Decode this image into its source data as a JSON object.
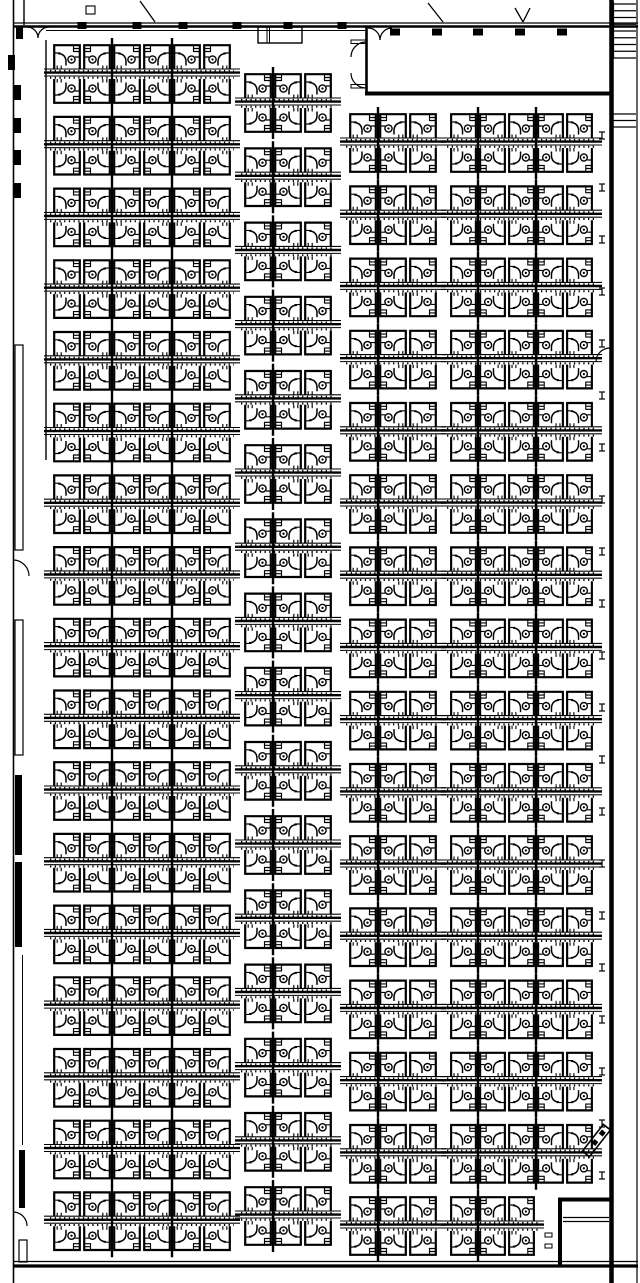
{
  "meta": {
    "canvas": {
      "w": 640,
      "h": 1283
    },
    "bg": "#ffffff",
    "ink": "#000000"
  },
  "plan": {
    "cluster": {
      "desk_h": 26,
      "spine_h": 10,
      "cluster_h": 62,
      "overhang": 8,
      "sep_rise": 5,
      "sep_drop": 67
    },
    "columns": [
      {
        "id": "left",
        "x": 52,
        "desk_w": 30,
        "desks": 6,
        "rows": 17,
        "row_start": 43,
        "row_step": 71.7,
        "separators": [
          2,
          4
        ]
      },
      {
        "id": "center",
        "x": 243,
        "desk_w": 30,
        "desks": 3,
        "rows": 16,
        "row_start": 72,
        "row_step": 74.2,
        "separators": [
          1
        ]
      },
      {
        "id": "right-inner",
        "x": 348,
        "desk_w": 30,
        "desks": 3,
        "rows": 16,
        "row_start": 112,
        "row_step": 72.2,
        "separators": [
          1
        ]
      },
      {
        "id": "right-outer",
        "x": 449,
        "desk_w": 29,
        "desks": 5,
        "rows": 16,
        "row_start": 112,
        "row_step": 72.2,
        "separators": [
          1,
          3
        ],
        "last_row_desks": 3
      }
    ],
    "walls": {
      "lines": [
        [
          13,
          23,
          638,
          23,
          1.2
        ],
        [
          13,
          26.5,
          638,
          26.5,
          2.4
        ],
        [
          46,
          30.5,
          365,
          30.5,
          1
        ],
        [
          13.5,
          0,
          13.5,
          1283,
          1.6
        ],
        [
          46,
          40,
          46,
          460,
          1.4
        ],
        [
          611.5,
          0,
          611.5,
          1283,
          4.5
        ],
        [
          637,
          0,
          637,
          1283,
          1.2
        ],
        [
          13,
          1261.5,
          638,
          1261.5,
          1.2
        ],
        [
          13,
          1266,
          638,
          1266,
          3.2
        ],
        [
          24,
          0,
          24,
          25,
          1.4
        ],
        [
          365,
          93.5,
          611,
          93.5,
          4
        ],
        [
          366.5,
          27,
          366.5,
          93,
          2.6
        ],
        [
          558,
          1199.5,
          611.5,
          1199.5,
          4
        ],
        [
          560,
          1199,
          560,
          1267,
          4
        ],
        [
          563,
          1217.5,
          609,
          1217.5,
          1.2
        ],
        [
          563,
          1221.5,
          609,
          1221.5,
          1.2
        ],
        [
          22.5,
          955,
          22.5,
          1145,
          1
        ]
      ],
      "filled": [
        [
          16,
          27,
          7,
          12
        ],
        [
          8,
          55,
          7,
          15
        ],
        [
          14,
          85,
          7,
          15
        ],
        [
          14,
          118,
          7,
          15
        ],
        [
          14,
          150,
          7,
          15
        ],
        [
          14,
          183,
          7,
          15
        ],
        [
          15,
          775,
          7,
          80
        ],
        [
          15,
          862,
          7,
          85
        ],
        [
          19,
          1150,
          6,
          58
        ]
      ],
      "outlined": [
        [
          15,
          345,
          8,
          205,
          1.2
        ],
        [
          15,
          620,
          8,
          135,
          1.2
        ],
        [
          19,
          1240,
          8,
          22,
          1.2
        ],
        [
          545,
          1233,
          7,
          4,
          1
        ],
        [
          545,
          1244,
          7,
          4,
          1
        ],
        [
          86,
          6,
          9,
          8,
          1.1
        ]
      ]
    },
    "doors": {
      "arcs": [
        "M27,27 A11,11 0 0 1 38,38",
        "M49,27 A11,11 0 0 0 38,38",
        "M368,28 A12,12 0 0 1 380,40",
        "M392,28 A12,12 0 0 0 380,40",
        "M366,42 A15,15 0 0 0 351,57",
        "M366,88 A15,15 0 0 1 351,73",
        "M610,348 A14,14 0 0 0 596,362",
        "M13,560 A16,16 0 0 1 29,576",
        "M13,1212 A14,14 0 0 1 27,1226"
      ],
      "leaves": [
        [
          351,
          40,
          15,
          3.5
        ],
        [
          351,
          84.5,
          15,
          3.5
        ]
      ],
      "diagonals": [
        [
          140,
          1,
          155,
          22
        ],
        [
          428,
          3,
          443,
          22
        ],
        [
          515,
          8,
          523,
          22
        ],
        [
          523,
          22,
          530,
          8
        ]
      ],
      "angled_panel": {
        "x": 600,
        "y": 1126,
        "w": 9,
        "h": 34,
        "angle": 38,
        "cx": 604,
        "cy": 1130
      }
    },
    "fixtures": {
      "top_mullions": {
        "xs": [
          82,
          137,
          183,
          237,
          288,
          342
        ],
        "y": 22,
        "w": 9,
        "h": 7
      },
      "room_mullions": {
        "xs": [
          395,
          437,
          478,
          520,
          562
        ],
        "y": 28.5,
        "w": 10,
        "h": 7
      },
      "stair": {
        "x1": 613.5,
        "x2": 636,
        "runs": [
          {
            "y0": 4,
            "y1": 58,
            "step": 6.75
          },
          {
            "y0": 114,
            "y1": 128,
            "step": 6.5
          }
        ]
      },
      "wall_ticks": {
        "x": 602,
        "y0": 132,
        "step": 52,
        "count": 21
      },
      "niche": {
        "rect": [
          258,
          27,
          44,
          16
        ],
        "inner_x": [
          267,
          269.5
        ]
      }
    }
  }
}
